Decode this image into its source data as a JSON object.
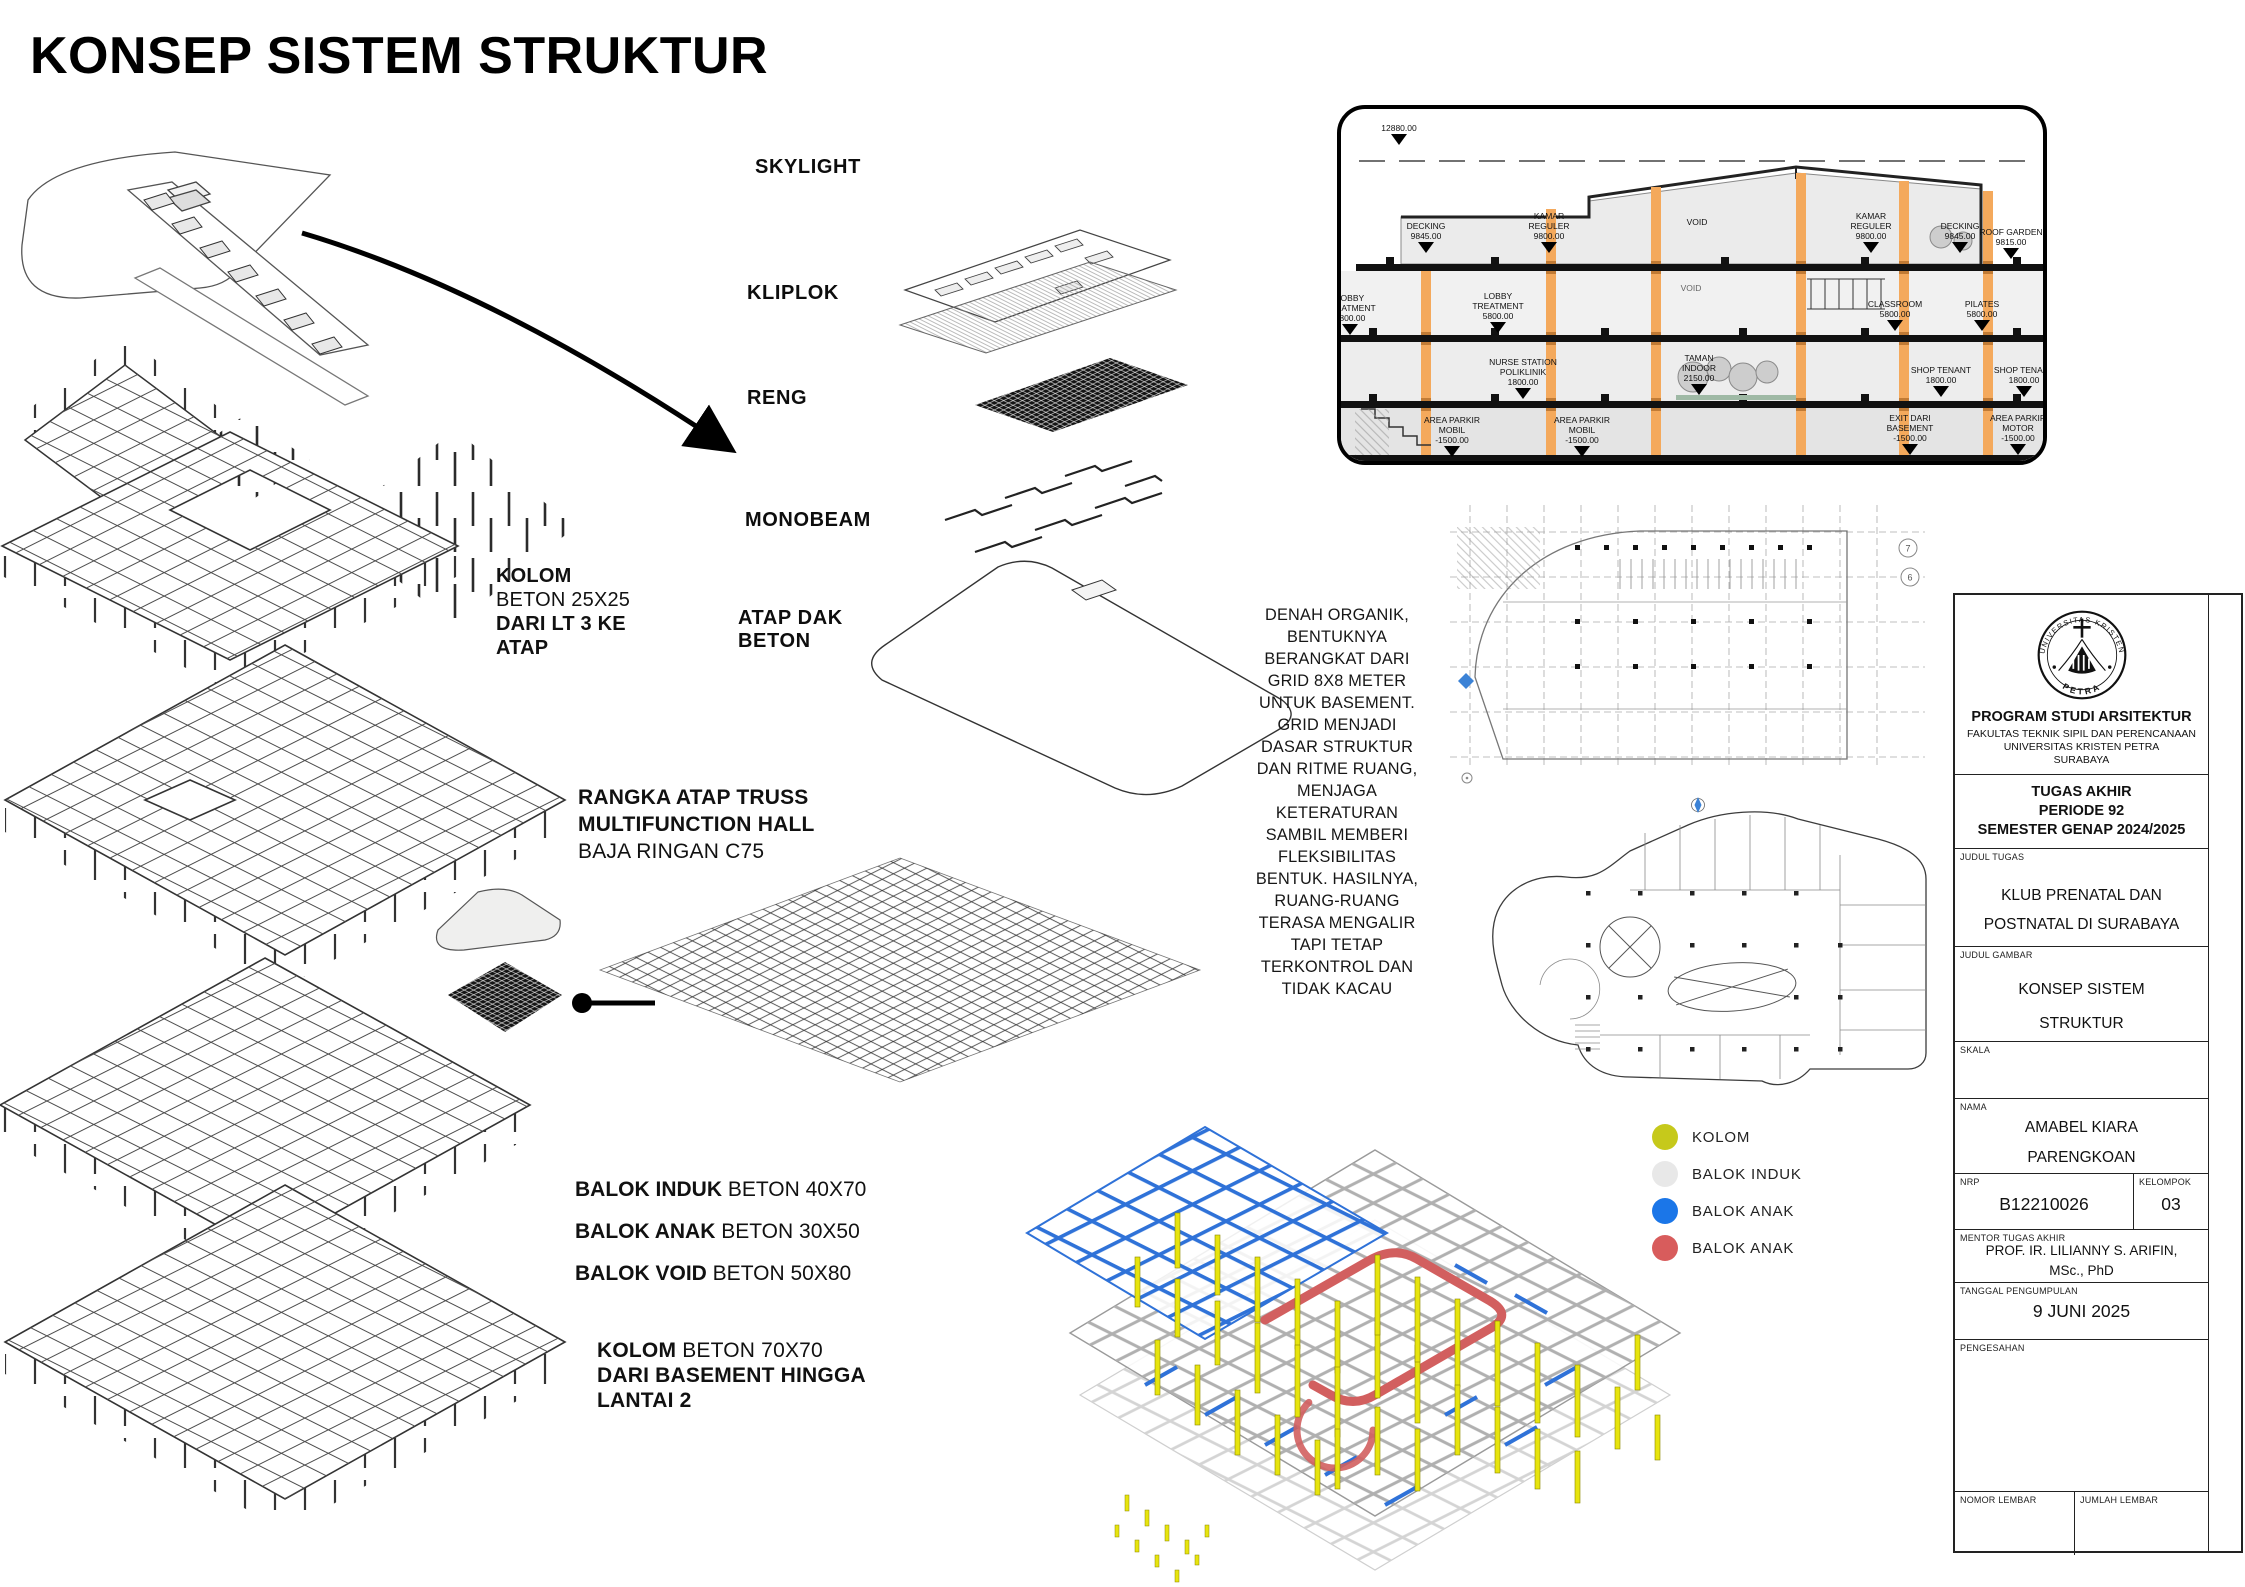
{
  "board": {
    "title": "KONSEP SISTEM STRUKTUR"
  },
  "colors": {
    "column_orange": "#f4a95c",
    "kolom_yellow": "#c6c91b",
    "balok_induk_gray": "#e8e8e8",
    "balok_anak_blue": "#1b76e8",
    "balok_anak_red": "#d85c5c"
  },
  "exploded": {
    "skylight": "SKYLIGHT",
    "kliplok": "KLIPLOK",
    "reng": "RENG",
    "monobeam": "MONOBEAM",
    "atap_dak": "ATAP DAK\nBETON"
  },
  "notes": {
    "kolom_atas": {
      "l1": "KOLOM",
      "l2": "BETON 25X25",
      "l3": "DARI LT 3 KE",
      "l4": "ATAP"
    },
    "rangka": {
      "l1": "RANGKA ATAP TRUSS",
      "l2": "MULTIFUNCTION HALL",
      "l3": "BAJA RINGAN C75"
    },
    "balok": [
      {
        "b": "BALOK INDUK",
        "r": " BETON 40X70"
      },
      {
        "b": "BALOK ANAK",
        "r": " BETON 30X50"
      },
      {
        "b": "BALOK VOID",
        "r": " BETON 50X80"
      }
    ],
    "kolom_bawah": {
      "b1": "KOLOM",
      "r1": " BETON 70X70",
      "l2": "DARI BASEMENT HINGGA",
      "l3": "LANTAI 2"
    }
  },
  "paragraph": "DENAH ORGANIK,\nBENTUKNYA\nBERANGKAT DARI\nGRID 8X8 METER\nUNTUK BASEMENT.\nGRID MENJADI\nDASAR STRUKTUR\nDAN RITME RUANG,\nMENJAGA\nKETERATURAN\nSAMBIL MEMBERI\nFLEKSIBILITAS\nBENTUK. HASILNYA,\nRUANG-RUANG\nTERASA MENGALIR\nTAPI TETAP\nTERKONTROL DAN\nTIDAK KACAU",
  "section": {
    "labels": [
      "12880.00",
      "DECKING\n9845.00",
      "KAMAR\nREGULER\n9800.00",
      "VOID",
      "KAMAR\nREGULER\n9800.00",
      "DECKING\n9845.00",
      "ROOF GARDEN\n9815.00",
      "LOBBY\nTREATMENT\n5800.00",
      "CLASSROOM\n5800.00",
      "PILATES\n5800.00",
      "NURSE STATION\nPOLIKLINIK\n1800.00",
      "TAMAN\nINDOOR\n2150.00",
      "SHOP TENANT\n1800.00",
      "SHOP TENANT\n1800.00",
      "AREA PARKIR\nMOBIL\n-1500.00",
      "AREA PARKIR\nMOBIL\n-1500.00",
      "EXIT DARI\nBASEMENT\n-1500.00",
      "AREA PARKIR\nMOTOR\n-1500.00",
      "LOBBY\nTREATMENT\n5800.00",
      "VOID"
    ]
  },
  "basement_plan": {
    "bubbles": [
      "7",
      "6"
    ]
  },
  "legend": [
    {
      "label": "KOLOM",
      "color": "#c6c91b"
    },
    {
      "label": "BALOK INDUK",
      "color": "#e8e8e8"
    },
    {
      "label": "BALOK ANAK",
      "color": "#1b76e8"
    },
    {
      "label": "BALOK ANAK",
      "color": "#d85c5c"
    }
  ],
  "titleblock": {
    "program": "PROGRAM STUDI ARSITEKTUR",
    "fakultas": "FAKULTAS TEKNIK SIPIL DAN PERENCANAAN",
    "universitas": "UNIVERSITAS KRISTEN PETRA",
    "kota": "SURABAYA",
    "periode": "TUGAS AKHIR\nPERIODE 92\nSEMESTER GENAP 2024/2025",
    "lab": {
      "judul_tugas": "JUDUL TUGAS",
      "judul_gambar": "JUDUL GAMBAR",
      "skala": "SKALA",
      "nama": "NAMA",
      "nrp": "NRP",
      "kelompok": "KELOMPOK",
      "mentor": "MENTOR TUGAS AKHIR",
      "tanggal": "TANGGAL PENGUMPULAN",
      "pengesahan": "PENGESAHAN",
      "nomor": "NOMOR LEMBAR",
      "jumlah": "JUMLAH LEMBAR"
    },
    "judul_tugas": "KLUB PRENATAL DAN\nPOSTNATAL DI SURABAYA",
    "judul_gambar": "KONSEP SISTEM\nSTRUKTUR",
    "nama": "AMABEL KIARA\nPARENGKOAN",
    "nrp": "B12210026",
    "kelompok": "03",
    "mentor": "PROF. IR. LILIANNY S. ARIFIN,\nMSc., PhD",
    "tanggal": "9 JUNI 2025",
    "logo_top": "UNIVERSITAS KRISTEN",
    "logo_bottom": "PETRA"
  }
}
